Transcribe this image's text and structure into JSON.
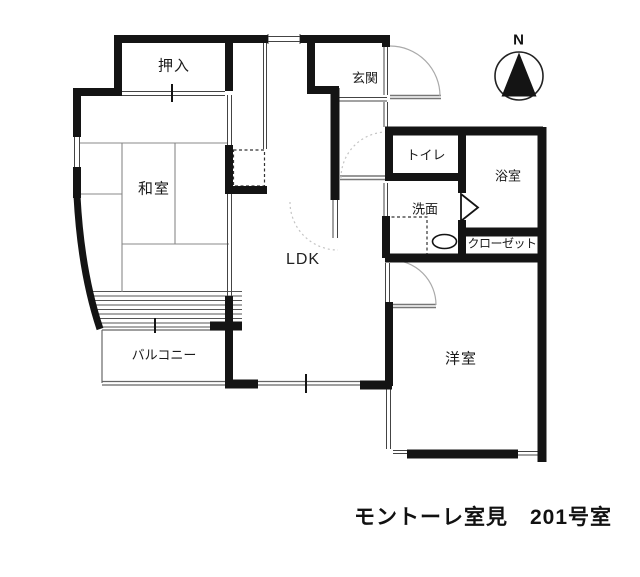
{
  "title": "モントーレ室見　201号室",
  "compass": {
    "label": "N"
  },
  "rooms": {
    "oshiire": {
      "label": "押入"
    },
    "washitsu": {
      "label": "和室"
    },
    "genkan": {
      "label": "玄関"
    },
    "toilet": {
      "label": "トイレ"
    },
    "bathroom": {
      "label": "浴室"
    },
    "washroom": {
      "label": "洗面"
    },
    "closet": {
      "label": "クローゼット"
    },
    "ldk": {
      "label": "LDK"
    },
    "balcony": {
      "label": "バルコニー"
    },
    "western_room": {
      "label": "洋室"
    }
  },
  "colors": {
    "wall": "#141414",
    "background": "#ffffff",
    "thin_line": "#555555",
    "door_arc": "#b0b0b0"
  }
}
